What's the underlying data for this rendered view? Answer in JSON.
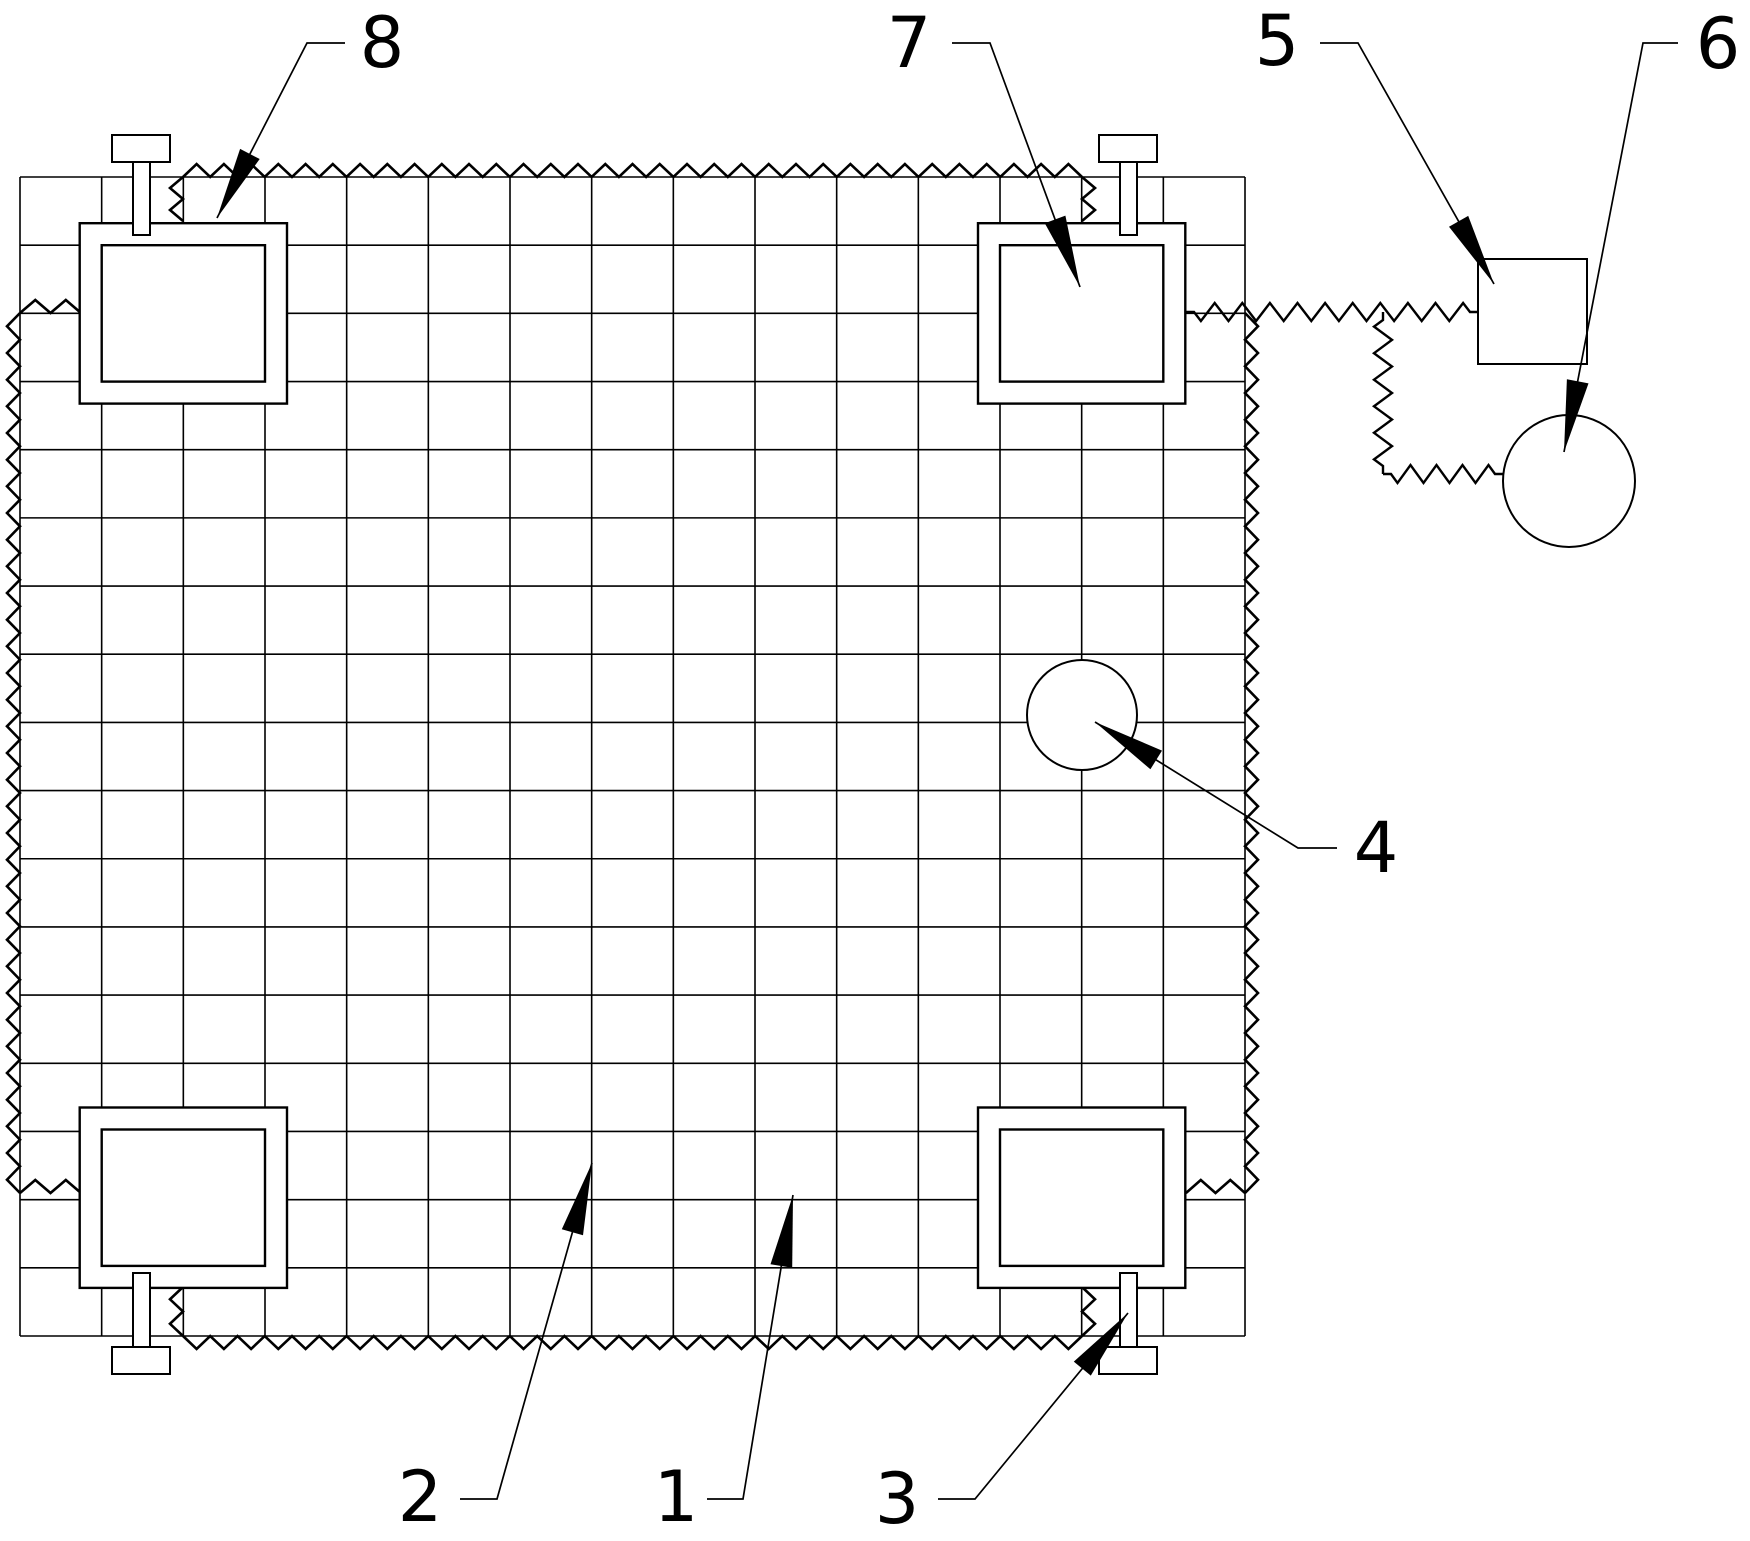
{
  "meta": {
    "figure_type": "patent-technical-drawing",
    "background_color": "#ffffff",
    "line_color": "#000000"
  },
  "diagram": {
    "grid": {
      "x": 20,
      "y": 177,
      "cols": 15,
      "rows": 17,
      "cell_w": 81.667,
      "cell_h": 68.176
    },
    "zig": {
      "period": 27,
      "height": 13,
      "half_step": 13.5,
      "amp": 9,
      "stub": 8
    },
    "arrow": {
      "len": 72,
      "halfwidth": 11
    },
    "edge_zigzags": [
      {
        "x1": 183,
        "y1": 177,
        "x2": 1082,
        "y2": 177,
        "nx": 0,
        "ny": -1
      },
      {
        "x1": 183,
        "y1": 177,
        "x2": 183,
        "y2": 221,
        "nx": -1,
        "ny": 0
      },
      {
        "x1": 1082,
        "y1": 177,
        "x2": 1082,
        "y2": 221,
        "nx": 1,
        "ny": 0
      },
      {
        "x1": 20,
        "y1": 313,
        "x2": 81,
        "y2": 313,
        "nx": 0,
        "ny": -1
      },
      {
        "x1": 20,
        "y1": 313,
        "x2": 20,
        "y2": 1193,
        "nx": -1,
        "ny": 0
      },
      {
        "x1": 20,
        "y1": 1193,
        "x2": 81,
        "y2": 1193,
        "nx": 0,
        "ny": -1
      },
      {
        "x1": 183,
        "y1": 1287,
        "x2": 183,
        "y2": 1336,
        "nx": -1,
        "ny": 0
      },
      {
        "x1": 183,
        "y1": 1336,
        "x2": 1082,
        "y2": 1336,
        "nx": 0,
        "ny": 1
      },
      {
        "x1": 1082,
        "y1": 1287,
        "x2": 1082,
        "y2": 1336,
        "nx": 1,
        "ny": 0
      },
      {
        "x1": 1186,
        "y1": 1193,
        "x2": 1245,
        "y2": 1193,
        "nx": 0,
        "ny": -1
      },
      {
        "x1": 1245,
        "y1": 313,
        "x2": 1245,
        "y2": 1193,
        "nx": 1,
        "ny": 0
      }
    ],
    "connector_zigzags": [
      {
        "x1": 1186,
        "y1": 312,
        "x2": 1478,
        "y2": 312
      },
      {
        "x1": 1383,
        "y1": 312,
        "x2": 1383,
        "y2": 474
      },
      {
        "x1": 1383,
        "y1": 474,
        "x2": 1503,
        "y2": 474
      }
    ],
    "clamps": [
      {
        "outer": {
          "x": 79.7,
          "y": 223.2,
          "w": 207.3,
          "h": 180.4
        },
        "inner": {
          "x": 101.7,
          "y": 245.2,
          "w": 163.3,
          "h": 136.4
        }
      },
      {
        "outer": {
          "x": 978.0,
          "y": 223.2,
          "w": 207.3,
          "h": 180.4
        },
        "inner": {
          "x": 1000.0,
          "y": 245.2,
          "w": 163.3,
          "h": 136.4
        }
      },
      {
        "outer": {
          "x": 79.7,
          "y": 1107.5,
          "w": 207.3,
          "h": 180.4
        },
        "inner": {
          "x": 101.7,
          "y": 1129.5,
          "w": 163.3,
          "h": 136.4
        }
      },
      {
        "outer": {
          "x": 978.0,
          "y": 1107.5,
          "w": 207.3,
          "h": 180.4
        },
        "inner": {
          "x": 1000.0,
          "y": 1129.5,
          "w": 163.3,
          "h": 136.4
        }
      }
    ],
    "bolts": [
      {
        "stem": {
          "x": 133,
          "y": 162,
          "w": 17,
          "h": 73
        },
        "cap": {
          "x": 112,
          "y": 135,
          "w": 58,
          "h": 27
        }
      },
      {
        "stem": {
          "x": 1120,
          "y": 162,
          "w": 17,
          "h": 73
        },
        "cap": {
          "x": 1099,
          "y": 135,
          "w": 58,
          "h": 27
        }
      },
      {
        "stem": {
          "x": 133,
          "y": 1273,
          "w": 17,
          "h": 74
        },
        "cap": {
          "x": 112,
          "y": 1347,
          "w": 58,
          "h": 27
        }
      },
      {
        "stem": {
          "x": 1120,
          "y": 1273,
          "w": 17,
          "h": 74
        },
        "cap": {
          "x": 1099,
          "y": 1347,
          "w": 58,
          "h": 27
        }
      }
    ],
    "circles": [
      {
        "name": "inner-circle-4",
        "cx": 1082,
        "cy": 715,
        "r": 55
      },
      {
        "name": "anchor-circle-6",
        "cx": 1569,
        "cy": 481,
        "r": 66
      }
    ],
    "square": {
      "x": 1478,
      "y": 259,
      "w": 109,
      "h": 105
    },
    "labels": [
      {
        "text": "1",
        "x": 676,
        "y": 1497,
        "leader": [
          [
            707,
            1499
          ],
          [
            743,
            1499
          ],
          [
            793,
            1195
          ]
        ]
      },
      {
        "text": "2",
        "x": 420,
        "y": 1497,
        "leader": [
          [
            460,
            1499
          ],
          [
            497,
            1499
          ],
          [
            592,
            1163
          ]
        ]
      },
      {
        "text": "3",
        "x": 897,
        "y": 1499,
        "leader": [
          [
            938,
            1499
          ],
          [
            975,
            1499
          ],
          [
            1128,
            1313
          ]
        ]
      },
      {
        "text": "4",
        "x": 1376,
        "y": 848,
        "leader": [
          [
            1337,
            848
          ],
          [
            1298,
            848
          ],
          [
            1095,
            722
          ]
        ]
      },
      {
        "text": "5",
        "x": 1277,
        "y": 41,
        "leader": [
          [
            1320,
            43
          ],
          [
            1358,
            43
          ],
          [
            1494,
            284
          ]
        ]
      },
      {
        "text": "6",
        "x": 1718,
        "y": 44,
        "leader": [
          [
            1678,
            43
          ],
          [
            1643,
            43
          ],
          [
            1564,
            452
          ]
        ]
      },
      {
        "text": "7",
        "x": 909,
        "y": 43,
        "leader": [
          [
            952,
            43
          ],
          [
            990,
            43
          ],
          [
            1080,
            287
          ]
        ]
      },
      {
        "text": "8",
        "x": 382,
        "y": 43,
        "leader": [
          [
            345,
            43
          ],
          [
            307,
            43
          ],
          [
            217,
            218
          ]
        ]
      }
    ]
  }
}
